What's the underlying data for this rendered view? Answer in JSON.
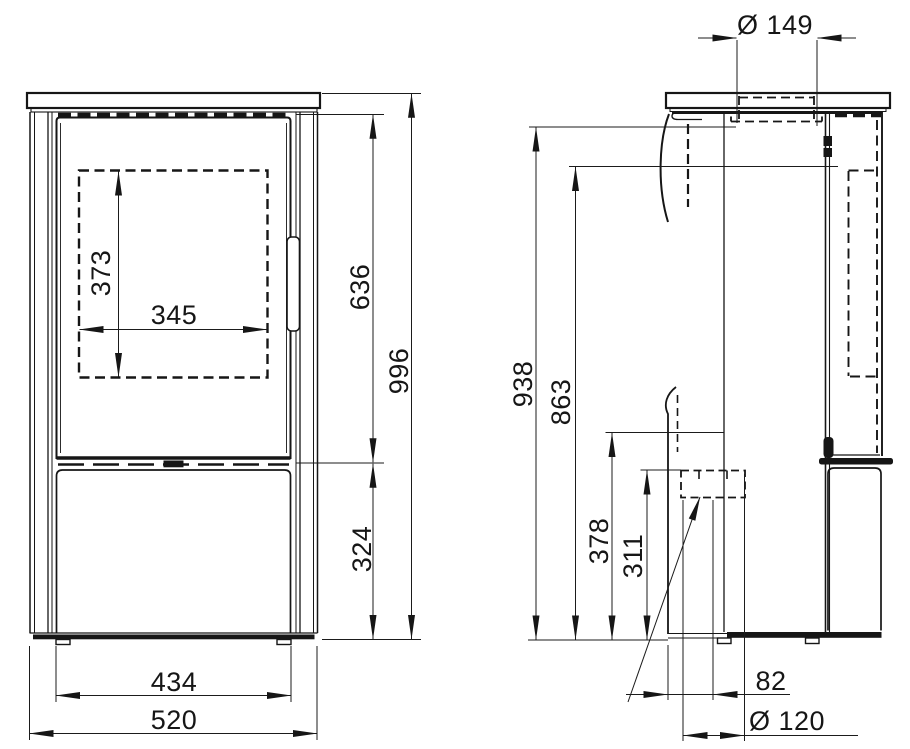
{
  "front": {
    "window_height": "373",
    "window_width": "345",
    "door_height": "636",
    "total_height": "996",
    "base_height": "324",
    "feet_width": "434",
    "total_width": "520"
  },
  "side": {
    "flue_diameter": "Ø 149",
    "body_top_height": "938",
    "rear_pipe_height": "863",
    "outlet_top_height": "378",
    "outlet_center_height": "311",
    "outlet_offset": "82",
    "outlet_diameter": "Ø 120"
  },
  "colors": {
    "line": "#161616",
    "background": "#ffffff"
  }
}
